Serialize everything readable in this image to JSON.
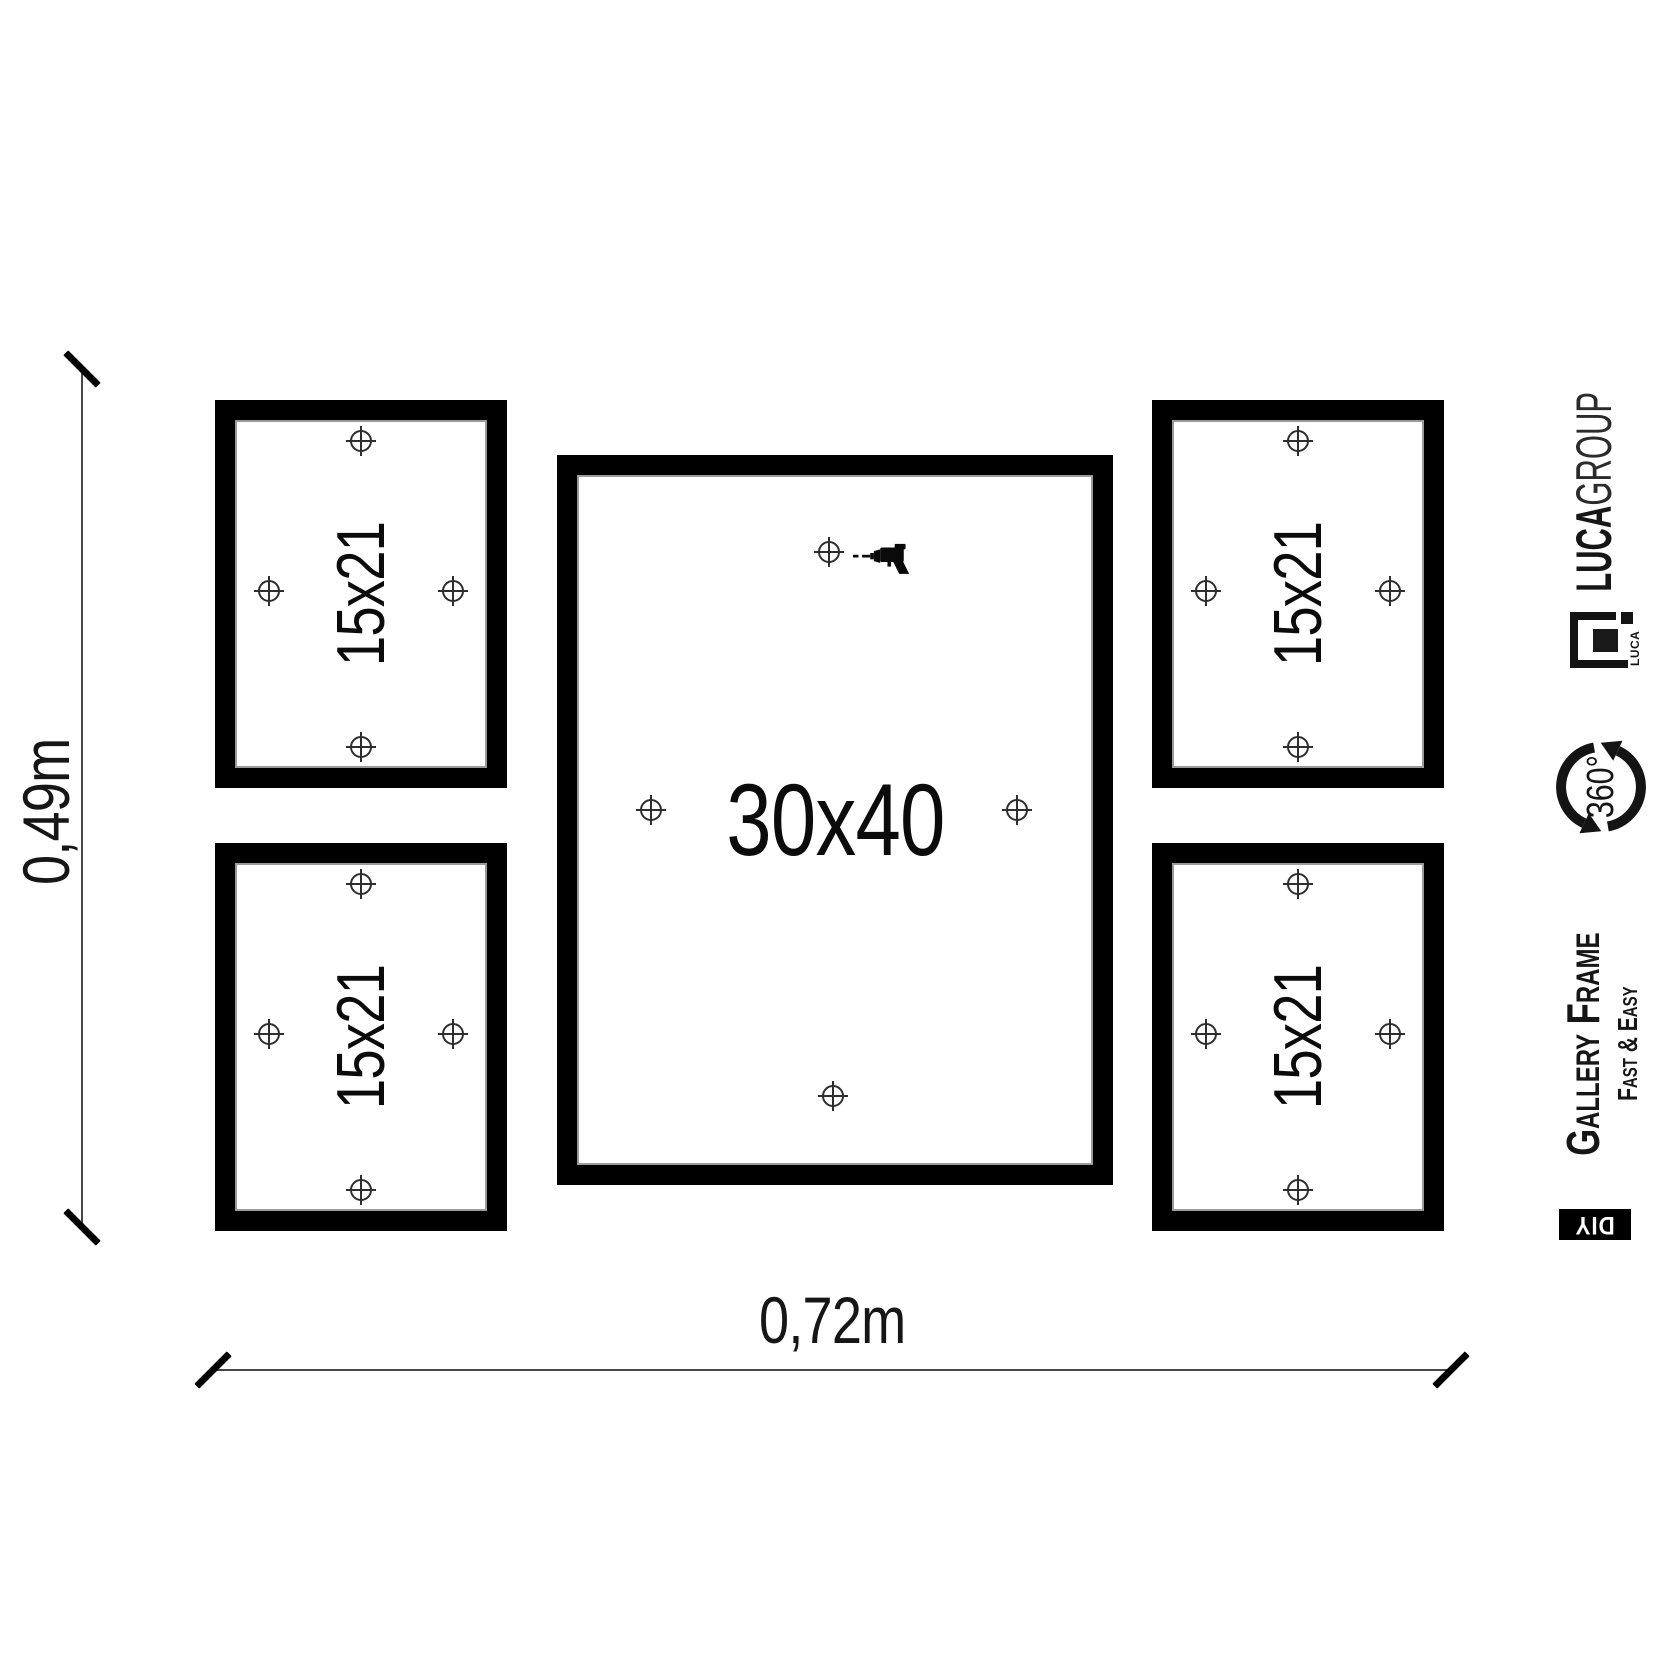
{
  "diagram": {
    "dimensions": {
      "height_label": "0,49m",
      "width_label": "0,72m"
    },
    "frames": {
      "top_left": {
        "label": "15x21"
      },
      "bottom_left": {
        "label": "15x21"
      },
      "center": {
        "label": "30x40"
      },
      "top_right": {
        "label": "15x21"
      },
      "bottom_right": {
        "label": "15x21"
      }
    }
  },
  "branding": {
    "company": {
      "bold": "LUCA",
      "light": "GROUP"
    },
    "logo": {
      "text": "LUCA"
    },
    "rotation": {
      "label": "360°"
    },
    "product": {
      "line1": "Gallery Frame",
      "line2": "Fast & Easy"
    },
    "diy": {
      "label": "DIY"
    }
  },
  "icons": {
    "crosshair": "drill-point-marker",
    "drill": "power-drill",
    "rotation": "circular-arrow-360"
  },
  "colors": {
    "ink": "#000000",
    "frame_hairline": "#9a9a9a",
    "dim_line": "#474747",
    "background": "#ffffff",
    "badge_bg": "#000000",
    "badge_text": "#ffffff"
  }
}
